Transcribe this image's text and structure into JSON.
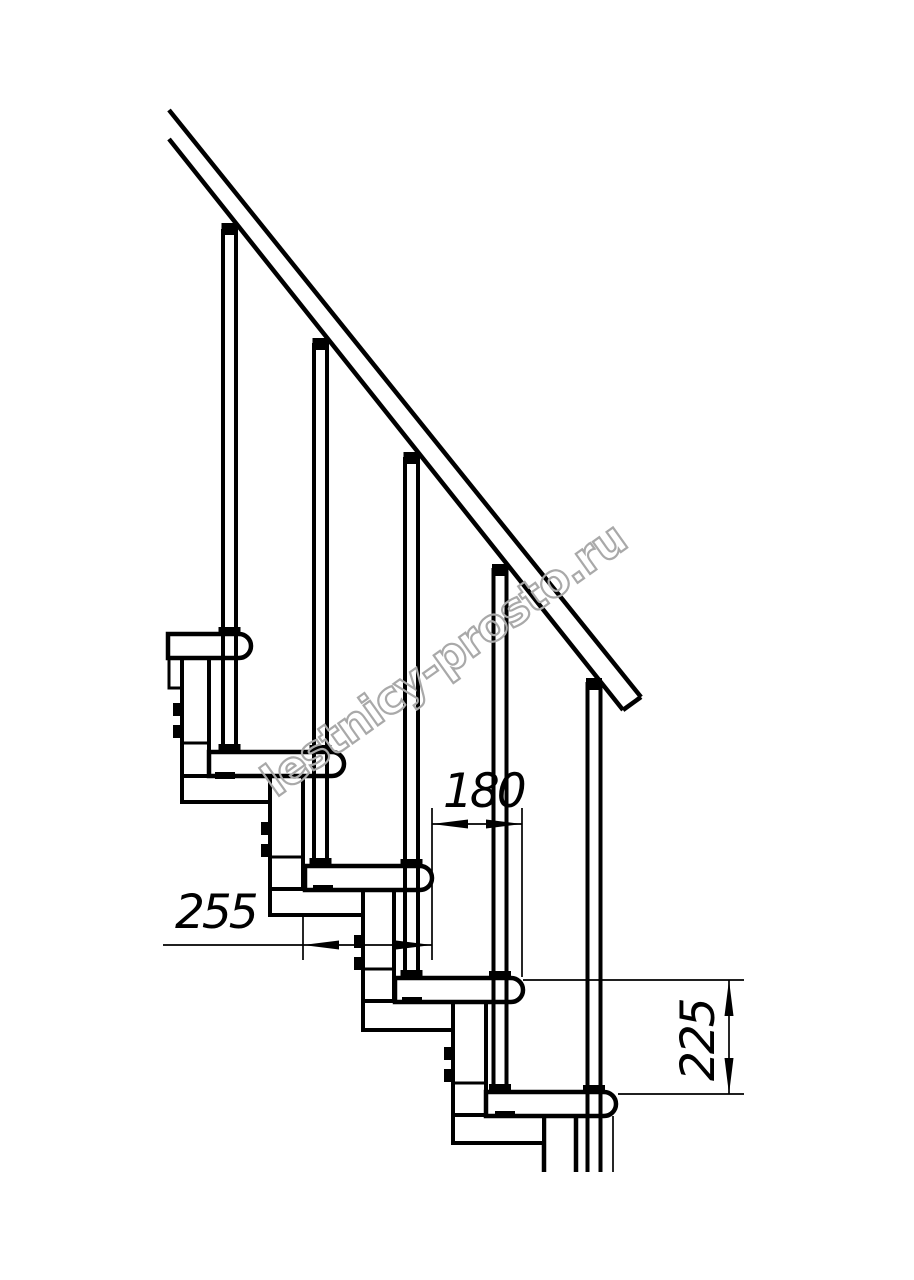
{
  "page": {
    "background_color": "#ffffff",
    "line_color": "#000000"
  },
  "drawing": {
    "kind": "staircase-side-elevation",
    "step_count_visible": 5,
    "baluster_count_visible": 5,
    "dimension_labels": {
      "run": "180",
      "tread_depth": "255",
      "rise": "225"
    }
  },
  "watermark": {
    "text": "lestnicy-prosto.ru",
    "color": "#a9a9a9"
  }
}
